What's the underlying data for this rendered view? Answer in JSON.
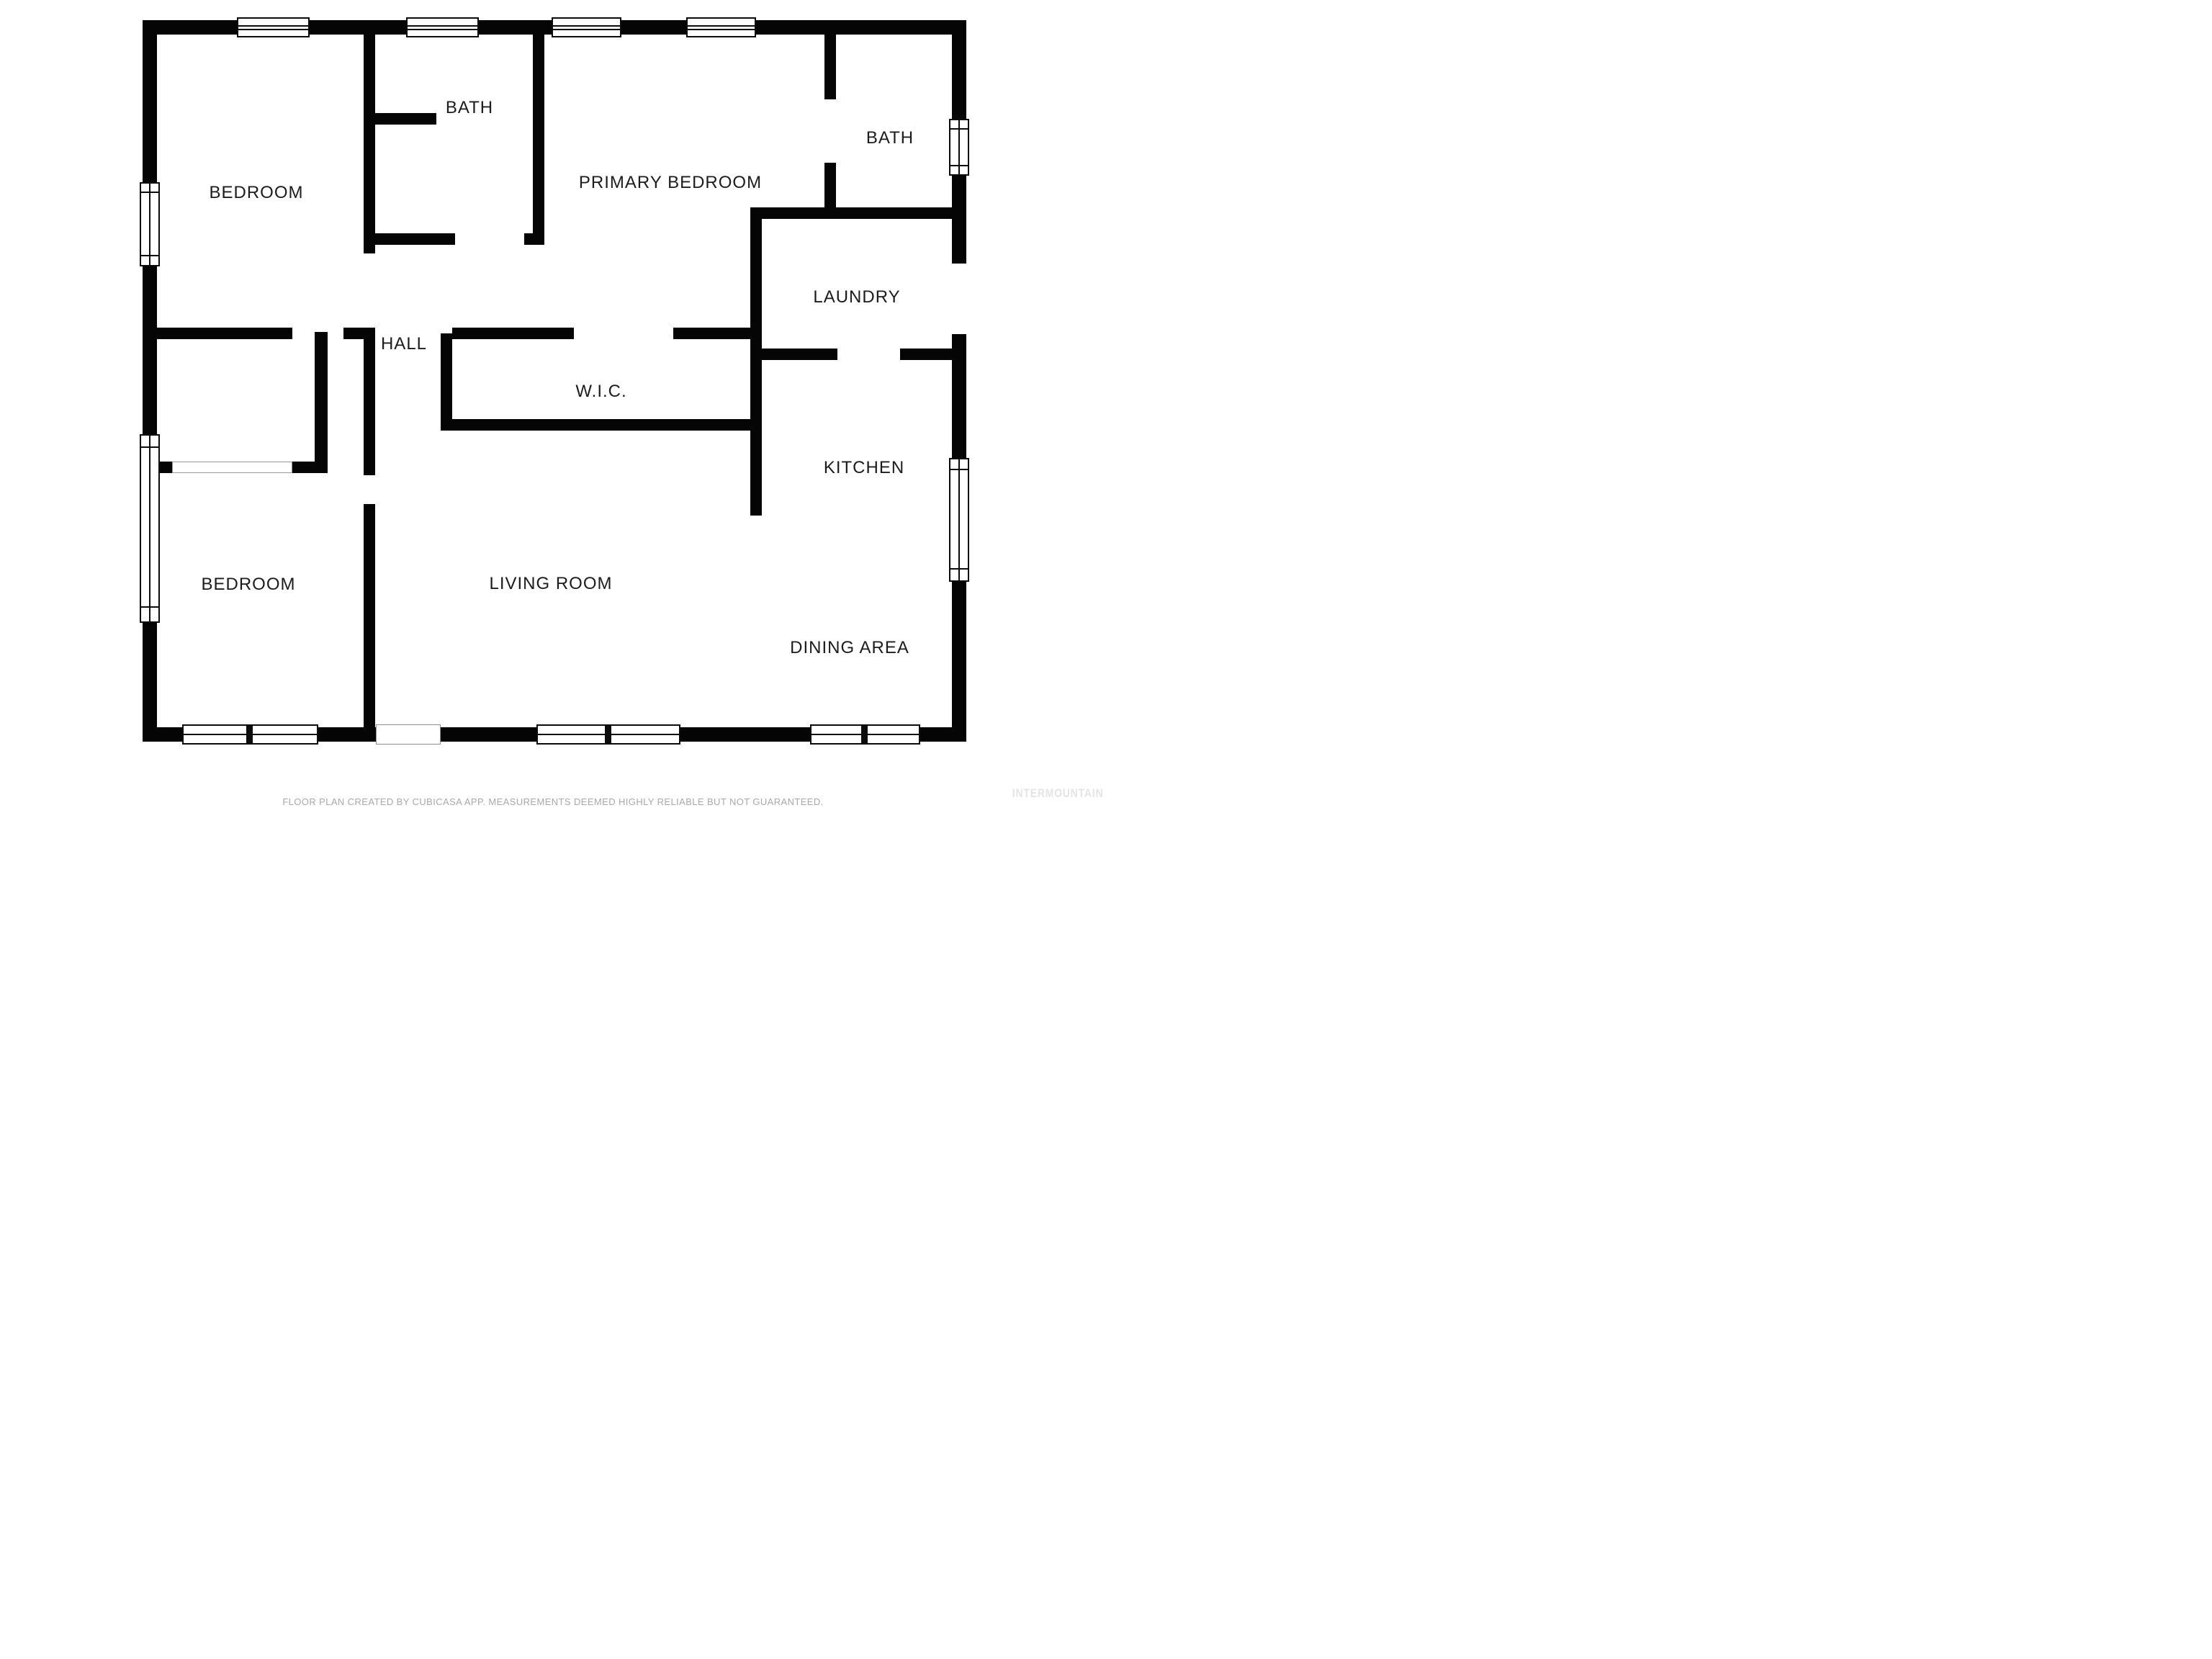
{
  "meta": {
    "type": "floor-plan",
    "colors": {
      "wall": "#050505",
      "background": "#ffffff",
      "room_label_text": "#1c1c1c",
      "footer_text": "#a8a8a8",
      "watermark_text": "#e4e4e4"
    }
  },
  "rooms": {
    "bedroom_top": {
      "label": "BEDROOM"
    },
    "bath_top": {
      "label": "BATH"
    },
    "primary_bedroom": {
      "label": "PRIMARY BEDROOM"
    },
    "bath_right": {
      "label": "BATH"
    },
    "laundry": {
      "label": "LAUNDRY"
    },
    "hall": {
      "label": "HALL"
    },
    "wic": {
      "label": "W.I.C."
    },
    "kitchen": {
      "label": "KITCHEN"
    },
    "bedroom_bottom": {
      "label": "BEDROOM"
    },
    "living_room": {
      "label": "LIVING ROOM"
    },
    "dining_area": {
      "label": "DINING AREA"
    }
  },
  "footer": {
    "disclaimer": "FLOOR PLAN CREATED BY CUBICASA APP. MEASUREMENTS DEEMED HIGHLY RELIABLE BUT NOT GUARANTEED."
  },
  "watermark": {
    "text": "INTERMOUNTAIN"
  }
}
